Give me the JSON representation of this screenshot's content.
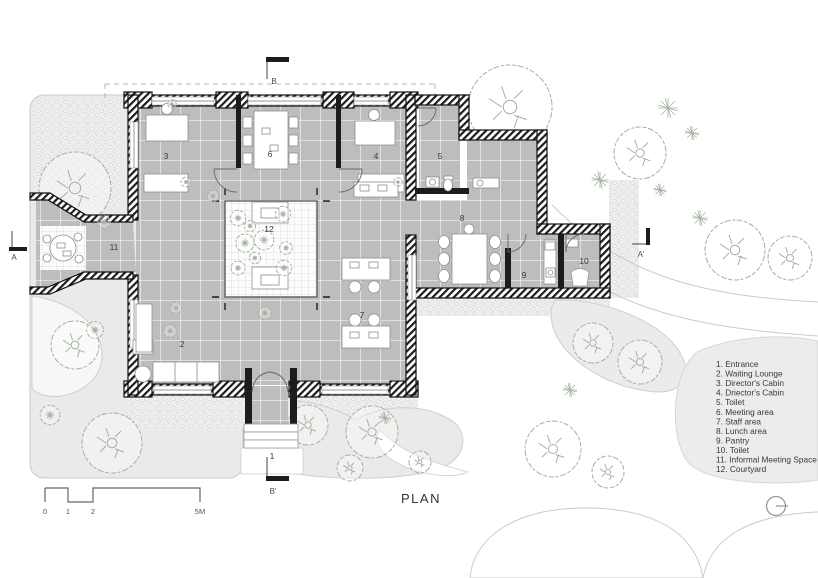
{
  "title": {
    "plan_label": "PLAN"
  },
  "legend": {
    "items": [
      "1. Entrance",
      "2. Waiting Lounge",
      "3. Director's Cabin",
      "4. Driector's Cabin",
      "5. Toilet",
      "6. Meeting area",
      "7. Staff area",
      "8. Lunch area",
      "9. Pantry",
      "10. Toilet",
      "11. Informal Meeting Space",
      "12. Courtyard"
    ]
  },
  "rooms": [
    {
      "number": "1",
      "label": "Entrance"
    },
    {
      "number": "2",
      "label": "Waiting Lounge"
    },
    {
      "number": "3",
      "label": "Director's Cabin"
    },
    {
      "number": "4",
      "label": "Driector's Cabin"
    },
    {
      "number": "5",
      "label": "Toilet"
    },
    {
      "number": "6",
      "label": "Meeting area"
    },
    {
      "number": "7",
      "label": "Staff area"
    },
    {
      "number": "8",
      "label": "Lunch area"
    },
    {
      "number": "9",
      "label": "Pantry"
    },
    {
      "number": "10",
      "label": "Toilet"
    },
    {
      "number": "11",
      "label": "Informal Meeting Space"
    },
    {
      "number": "12",
      "label": "Courtyard"
    }
  ],
  "section_markers": {
    "a": "A",
    "a_prime": "A'",
    "b": "B",
    "b_prime": "B'"
  },
  "scale_bar": {
    "labels": [
      "0",
      "1",
      "2",
      "5M"
    ]
  },
  "icons": {
    "north_indicator": "circle-with-line"
  },
  "colors": {
    "wall": "#1c1c1c",
    "floor_tile": "#bdbdbd",
    "courtyard": "#fcfcfc",
    "landscape": "#eaeaea",
    "vegetation": "#a3b29e",
    "text": "#3a3a3a"
  }
}
